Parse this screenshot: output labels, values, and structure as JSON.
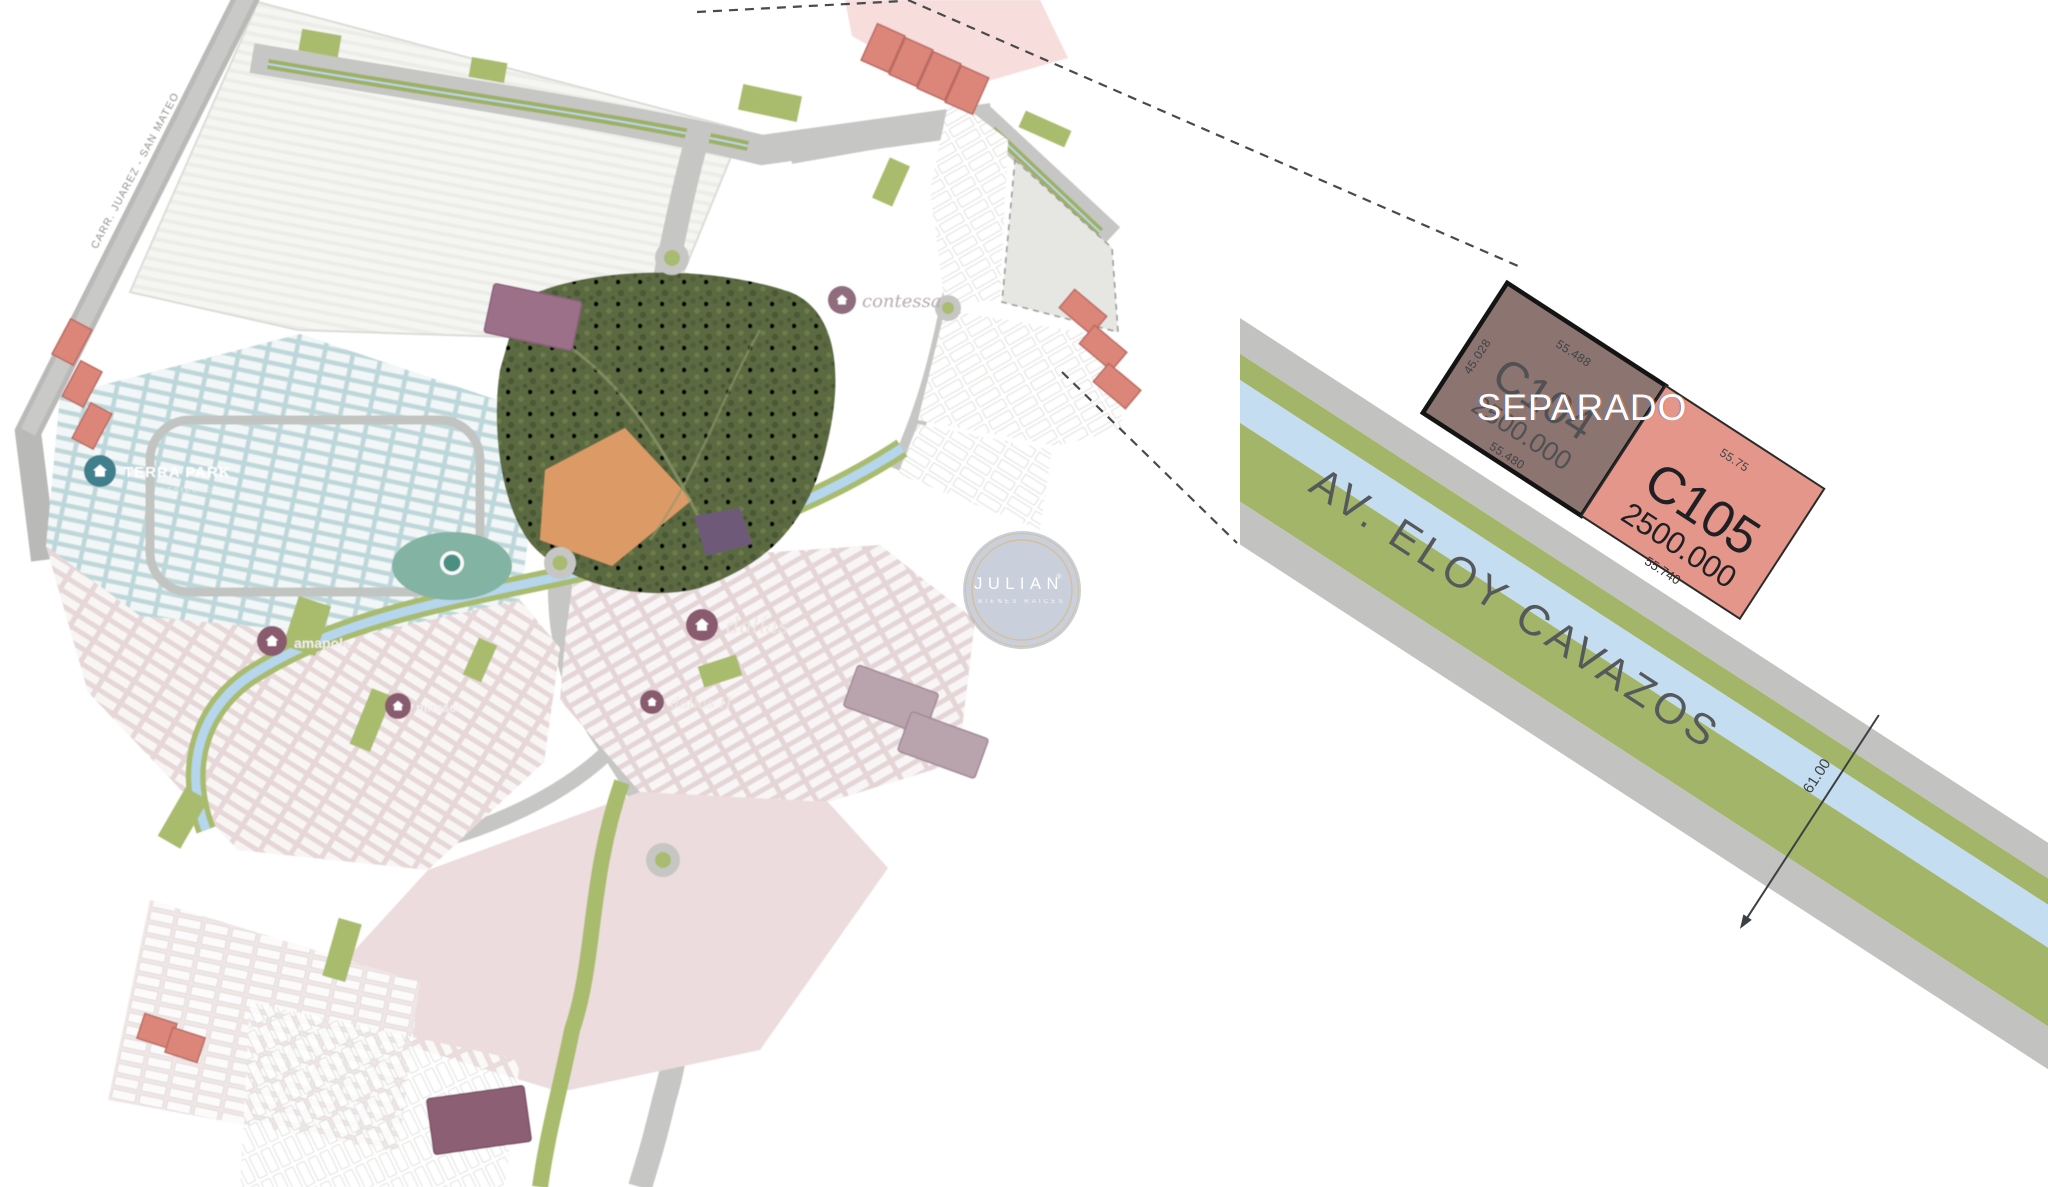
{
  "map": {
    "road_label": "CARR. JUAREZ - SAN MATEO",
    "neighborhoods": {
      "terra_park": {
        "name": "TERRA PARK",
        "sub": "RESIDENCIAL"
      },
      "contessa": {
        "name": "contessa"
      },
      "amapola": {
        "name": "amapola"
      },
      "mirasol": {
        "name": "mirasol"
      },
      "dalias": {
        "name": "dalías"
      },
      "dalias2": {
        "name": "dalías II"
      }
    }
  },
  "watermark": {
    "brand": "JULIAN",
    "reg": "®",
    "tagline": "BIENES RAICES"
  },
  "detail": {
    "street": "AV. ELOY CAVAZOS",
    "road_width": "61.00",
    "lots": [
      {
        "id": "C104",
        "area": "2500.000",
        "status": "SEPARADO",
        "dim_top": "55.488",
        "dim_bottom": "55.480",
        "dim_left": "45.028",
        "dim_right": "45.042",
        "color": "#8c7470"
      },
      {
        "id": "C105",
        "area": "2500.000",
        "dim_top": "55.75",
        "dim_bottom": "55.740",
        "color": "#e5968a"
      }
    ]
  },
  "colors": {
    "road": "#c4c5c2",
    "green_strip": "#a3b568",
    "water": "#c5ddf0",
    "park": "#5c6a43",
    "pink_zone": "#e9d6d8",
    "blue_zone": "#b9d8dd",
    "salmon_lot": "#dc8579",
    "lot_c104": "#8c7470",
    "lot_c105": "#e5968a",
    "watermark_fill": "#9caabe",
    "watermark_ring": "#d6bd92"
  }
}
